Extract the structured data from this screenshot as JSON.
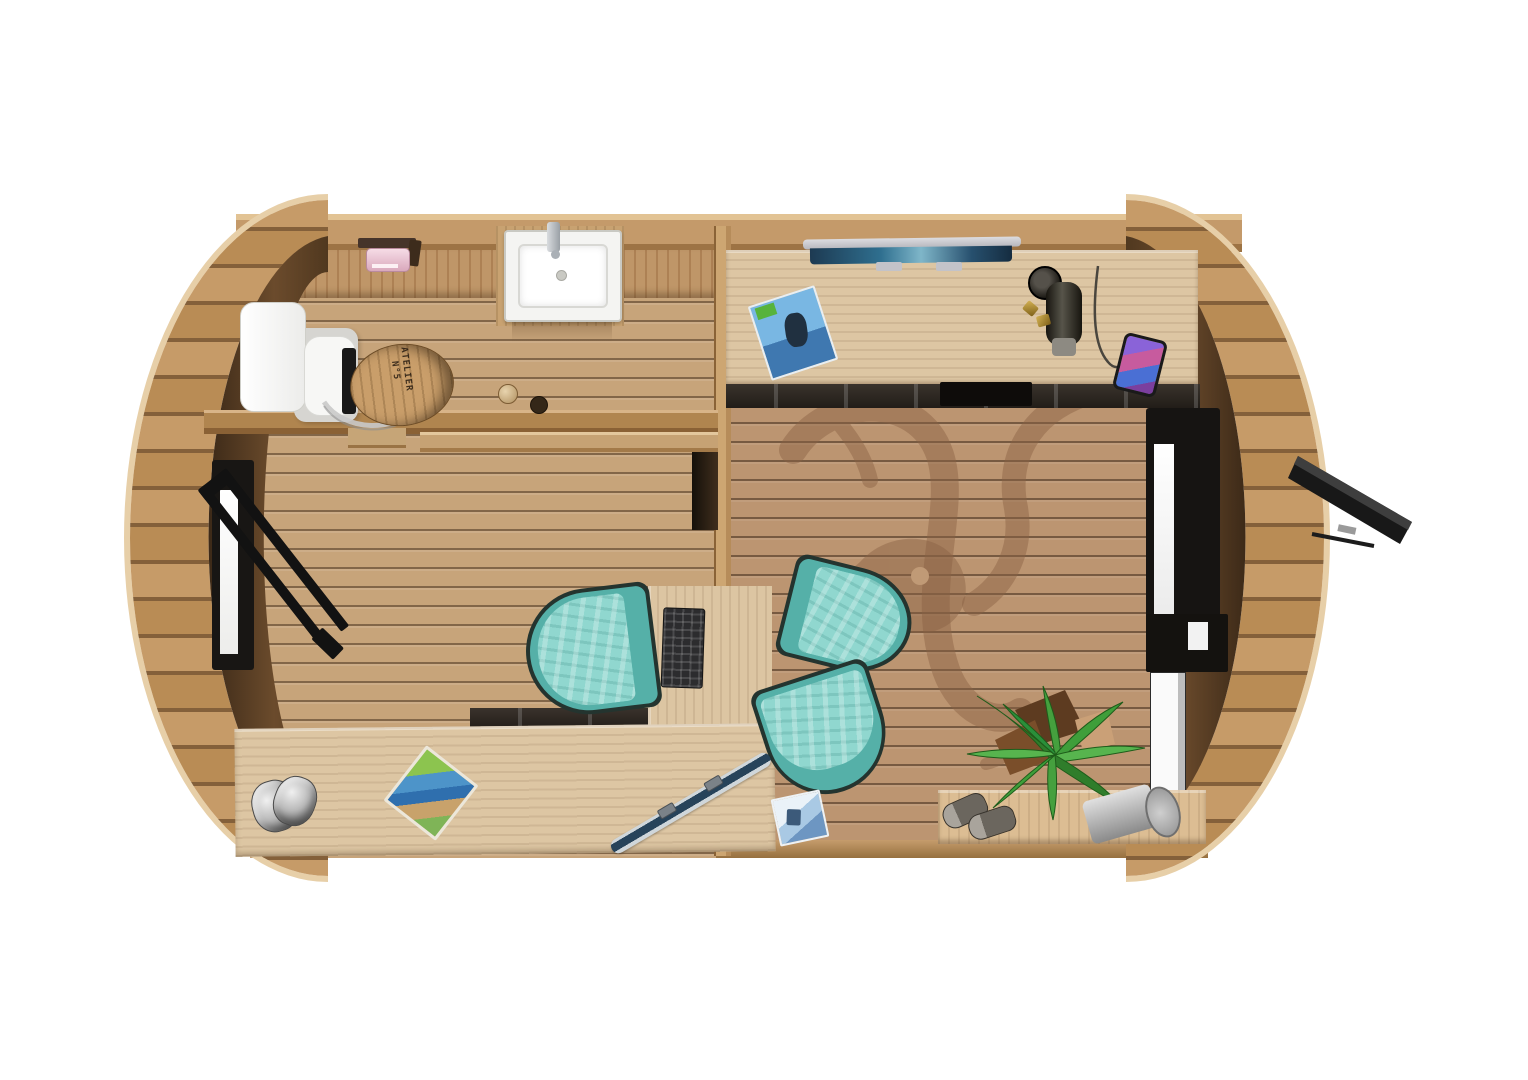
{
  "meta": {
    "title": "Barrel cabin — top-down 3D floor plan render",
    "render_type": "plan view of a barrel-shaped office pod",
    "background": "#ffffff"
  },
  "palette": {
    "stave_light": "#c69b68",
    "stave_mid": "#b98c55",
    "stave_gap": "#84603a",
    "end_wall_dark": "#4a3420",
    "end_wall_light": "#75522f",
    "floor_left": "#c7a47a",
    "floor_right": "#bc9571",
    "plank_line": "#4a3420",
    "divider_wall": "#cda672",
    "desk_wood": "#ddc6a3",
    "chair_teal": "#90d7cf",
    "chair_teal_rim": "#55b0a8",
    "chair_outline": "#24342f",
    "accent_black": "#161412",
    "toilet_paper_pink": "#e9c0ce",
    "watermark_brown": "#8a6244",
    "plant_green": "#3f9e3a"
  },
  "structure": {
    "left_end": "wooden stave barrel rim with dark end wall",
    "right_end": "wooden stave barrel rim with window, glass door and open hatch",
    "rooms": [
      {
        "id": "left",
        "label": "Bathroom & workspace",
        "features": [
          "toilet with barrel lid",
          "washbasin",
          "toilet-paper holder",
          "partition shelf",
          "open door in left wall",
          "vertical work desk",
          "teal desk chair",
          "keyboard",
          "long counter desk",
          "ski",
          "trail map",
          "grey bag"
        ]
      },
      {
        "id": "right",
        "label": "Office / lounge",
        "features": [
          "long wall desk",
          "monitor",
          "magazine",
          "thermos",
          "grinder knobs",
          "smartphone with charging cable",
          "under-desk drawer row",
          "two teal lounge chairs",
          "floor magazine",
          "palm plant",
          "sneakers",
          "metal bin",
          "bench",
          "window",
          "glass door",
          "open awning hatch",
          "deer logo watermark on floor"
        ]
      }
    ]
  },
  "objects": {
    "toilet_lid": {
      "line1": "ATELIER",
      "line2": "N°5"
    },
    "chairs": {
      "count": 3,
      "color": "#90d7cf"
    },
    "watermark": {
      "shape": "stag head with antlers",
      "color": "#8a6244",
      "opacity": 0.45
    }
  }
}
